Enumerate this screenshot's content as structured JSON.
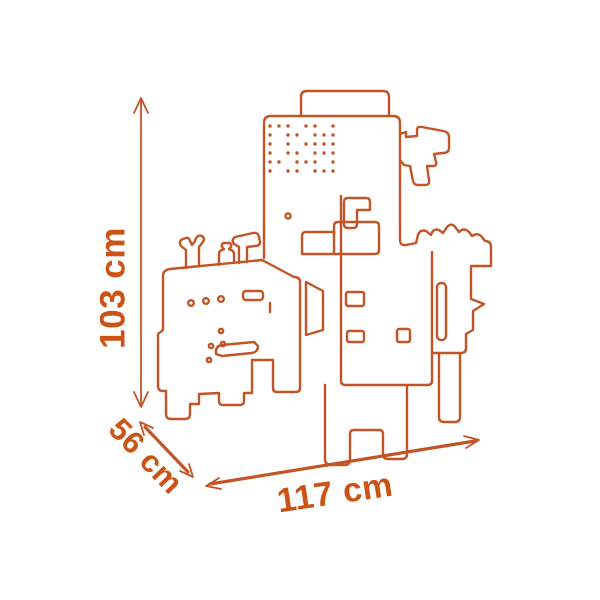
{
  "scene": {
    "background": "#ffffff",
    "line_color": "#c25425",
    "label_color": "#cb5315",
    "subject": "toy workbench outline drawing with dimension arrows"
  },
  "dimensions": {
    "height": {
      "label": "103 cm"
    },
    "depth": {
      "label": "56 cm"
    },
    "width": {
      "label": "117 cm"
    }
  },
  "drawing": {
    "pegboard": {
      "cols": 8,
      "rows": 6,
      "spacing": 9,
      "origin_x": 270,
      "origin_y": 126,
      "dot_radius": 1.7,
      "missing": [
        3,
        6,
        9,
        12,
        17,
        19,
        25,
        28,
        34,
        38,
        41,
        44
      ]
    }
  }
}
